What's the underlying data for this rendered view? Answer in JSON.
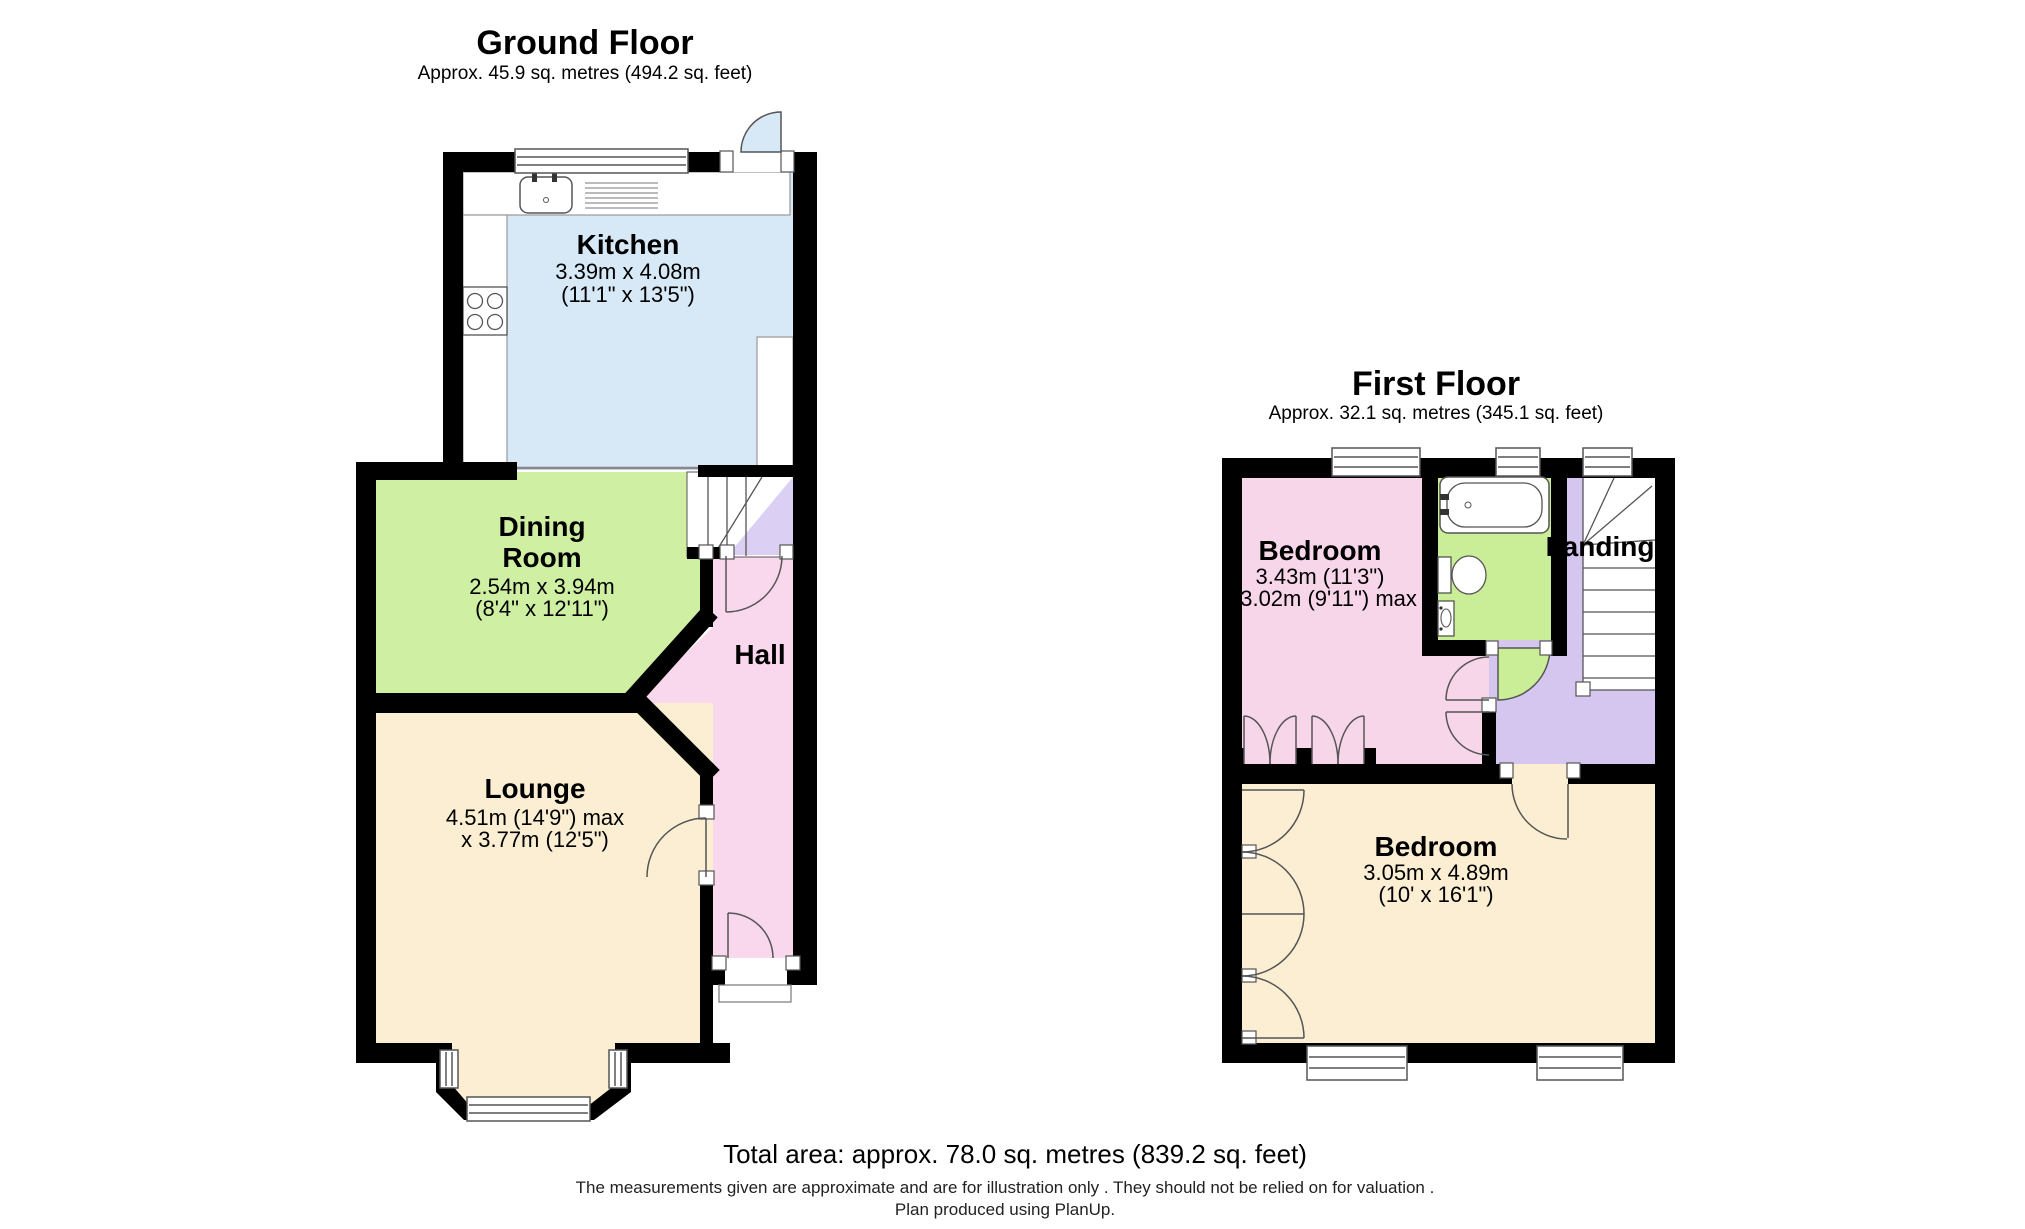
{
  "ground_floor": {
    "title": "Ground Floor",
    "area": "Approx. 45.9 sq. metres (494.2 sq. feet)",
    "rooms": {
      "kitchen": {
        "name": "Kitchen",
        "dims_metric": "3.39m x 4.08m",
        "dims_imperial": "(11'1\" x 13'5\")"
      },
      "dining": {
        "name_line1": "Dining",
        "name_line2": "Room",
        "dims_metric": "2.54m x 3.94m",
        "dims_imperial": "(8'4\" x 12'11\")"
      },
      "hall": {
        "name": "Hall"
      },
      "lounge": {
        "name": "Lounge",
        "dims_line1": "4.51m (14'9\") max",
        "dims_line2": "x 3.77m (12'5\")"
      }
    }
  },
  "first_floor": {
    "title": "First Floor",
    "area": "Approx. 32.1 sq. metres (345.1 sq. feet)",
    "rooms": {
      "bedroom1": {
        "name": "Bedroom",
        "dims_line1": "3.43m (11'3\")",
        "dims_line2": "x 3.02m (9'11\") max"
      },
      "landing": {
        "name": "Landing"
      },
      "bedroom2": {
        "name": "Bedroom",
        "dims_metric": "3.05m x 4.89m",
        "dims_imperial": "(10' x 16'1\")"
      }
    }
  },
  "footer": {
    "total_area": "Total area: approx. 78.0 sq. metres (839.2 sq. feet)",
    "disclaimer_line1": "The measurements given are approximate and are for illustration only . They should not be relied on for valuation .",
    "disclaimer_line2": "Plan produced using PlanUp."
  },
  "colors": {
    "kitchen": "#d7e9f7",
    "dining": "#cff0a3",
    "hall": "#f9d7ec",
    "lounge": "#fbeed3",
    "bedroom": "#f8d6ea",
    "bathroom": "#c9ee97",
    "landing": "#d4c6ef",
    "understairs": "#dccff4",
    "wall": "#000000"
  }
}
